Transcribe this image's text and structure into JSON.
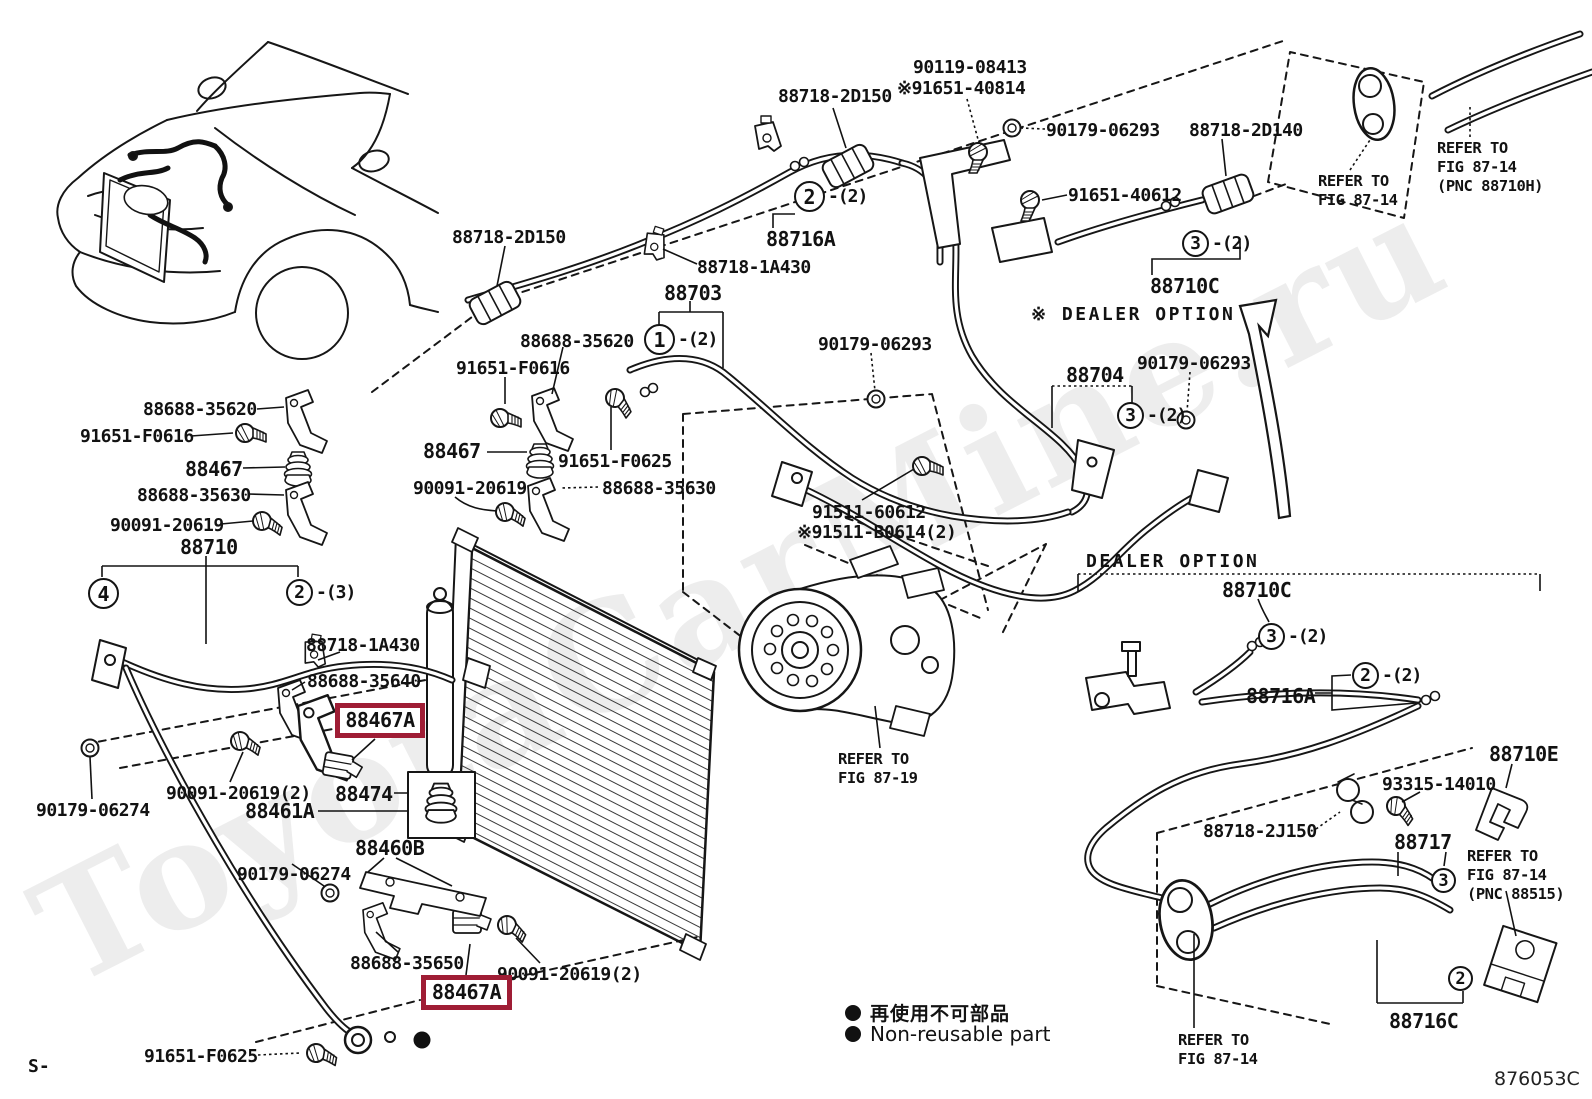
{
  "watermark": "ToyotaCarMine.ru",
  "figure_code": "876053C",
  "corner_code": "S-",
  "highlight_color": "#9f1d35",
  "legend": {
    "jp": "再使用不可部品",
    "en": "Non-reusable part"
  },
  "labels": [
    "88718-2D150",
    "90119-08413",
    "※91651-40814",
    "90179-06293",
    "88718-2D140",
    "91651-40612",
    "88716A",
    "88718-1A430",
    "88703",
    "88718-2D150",
    "88688-35620",
    "91651-F0616",
    "88467",
    "91651-F0625",
    "90091-20619",
    "88688-35630",
    "88688-35620",
    "91651-F0616",
    "88467",
    "88688-35630",
    "90091-20619",
    "88710",
    "88718-1A430",
    "88688-35640",
    "88467A",
    "90091-20619(2)",
    "88474",
    "88461A",
    "88460B",
    "90179-06274",
    "90179-06274",
    "88688-35650",
    "90091-20619(2)",
    "88467A",
    "91651-F0625",
    "90179-06293",
    "88704",
    "90179-06293",
    "91511-60612",
    "※91511-B0614(2)",
    "88710C",
    "※ DEALER OPTION",
    "REFER TO\nFIG 87-14",
    "REFER TO\nFIG 87-14\n(PNC 88710H)",
    "REFER TO\nFIG 87-19",
    "DEALER OPTION",
    "88710C",
    "88716A",
    "88710E",
    "93315-14010",
    "88718-2J150",
    "88717",
    "REFER TO\nFIG 87-14\n(PNC 88515)",
    "REFER TO\nFIG 87-14",
    "88716C"
  ],
  "callouts": [
    {
      "num": "2",
      "suffix": "-(2)"
    },
    {
      "num": "1",
      "suffix": "-(2)"
    },
    {
      "num": "3",
      "suffix": "-(2)"
    },
    {
      "num": "3",
      "suffix": "-(2)"
    },
    {
      "num": "4",
      "suffix": ""
    },
    {
      "num": "2",
      "suffix": "-(3)"
    },
    {
      "num": "3",
      "suffix": "-(2)"
    },
    {
      "num": "2",
      "suffix": "-(2)"
    },
    {
      "num": "3",
      "suffix": ""
    },
    {
      "num": "2",
      "suffix": ""
    }
  ]
}
